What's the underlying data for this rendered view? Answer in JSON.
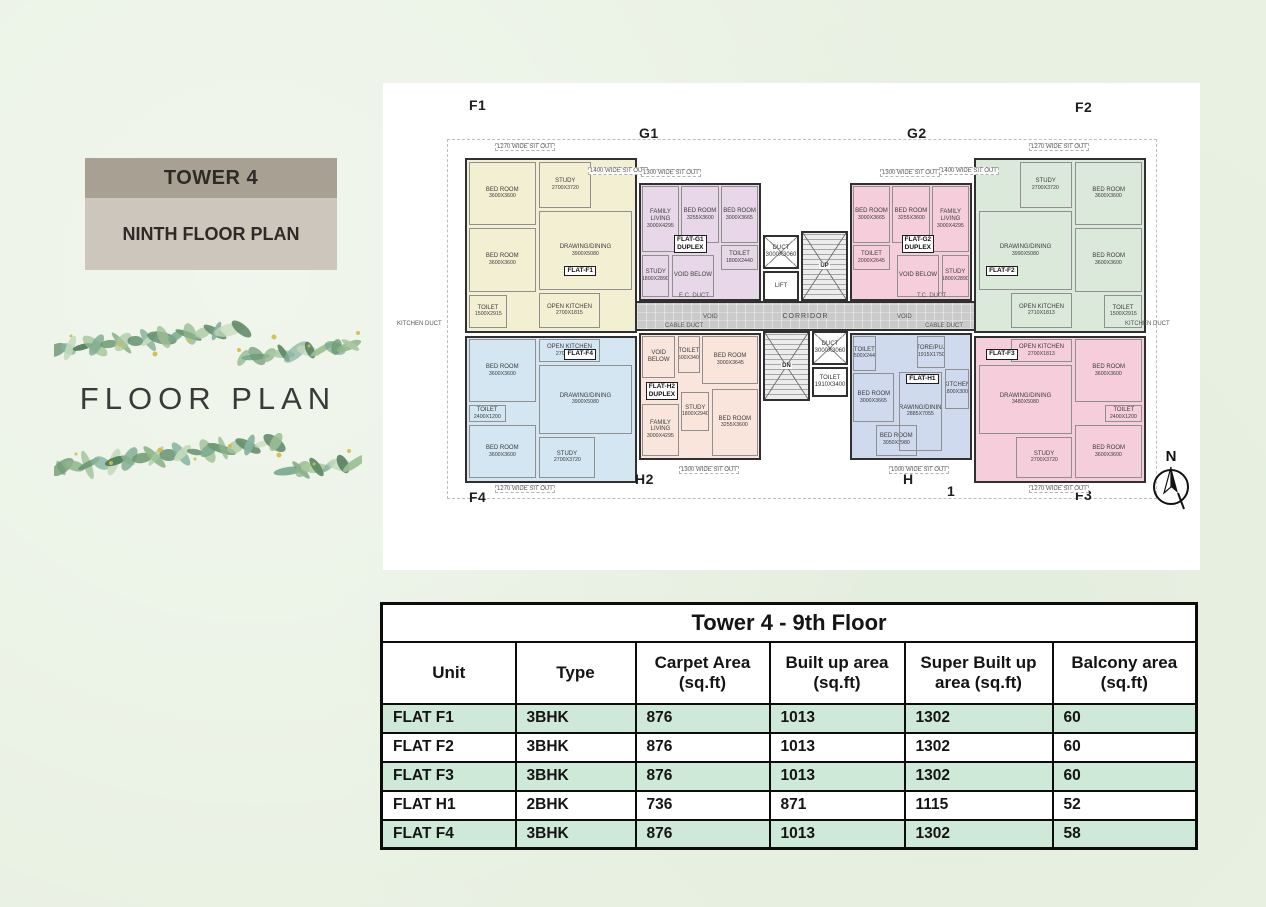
{
  "colors": {
    "page_bg": "#e9f1e3",
    "panel_bg": "#ffffff",
    "badge_top_bg": "#a8a092",
    "badge_bottom_bg": "#cdc6bc",
    "table_green": "#cfe9d8",
    "table_border": "#0c0c0c",
    "wall": "#303030",
    "corridor": "#cacaca",
    "units": {
      "F1": "#f3efd3",
      "G1": "#e8d7e8",
      "G2": "#f6cedb",
      "F2": "#dbe9da",
      "F4": "#d3e6f2",
      "H2": "#f9e5dc",
      "H1": "#cfdaee",
      "F3": "#f6cedb"
    }
  },
  "left_panel": {
    "tower_label": "TOWER 4",
    "floor_label": "NINTH FLOOR PLAN",
    "decor_title": "FLOOR PLAN"
  },
  "floorplan": {
    "north_label": "N",
    "outline": {
      "x": 64,
      "y": 56,
      "w": 710,
      "h": 360
    },
    "corridor": {
      "label": "CORRIDOR",
      "x": 254,
      "y": 218,
      "w": 337,
      "h": 30
    },
    "units": [
      {
        "id": "F1",
        "x": 82,
        "y": 75,
        "w": 172,
        "h": 175,
        "tag": "FLAT-F1",
        "tx": 58,
        "ty": 62,
        "rooms": [
          {
            "n": "BED ROOM",
            "d": "3600X3600",
            "x": 1,
            "y": 1,
            "w": 40,
            "h": 37
          },
          {
            "n": "STUDY",
            "d": "2700X3720",
            "x": 43,
            "y": 1,
            "w": 31,
            "h": 27
          },
          {
            "n": "BED ROOM",
            "d": "3600X3600",
            "x": 1,
            "y": 40,
            "w": 40,
            "h": 37
          },
          {
            "n": "TOILET",
            "d": "1500X2915",
            "x": 1,
            "y": 79,
            "w": 23,
            "h": 19
          },
          {
            "n": "DRAWING/DINING",
            "d": "3900X5080",
            "x": 43,
            "y": 30,
            "w": 55,
            "h": 46
          },
          {
            "n": "OPEN KITCHEN",
            "d": "2700X1815",
            "x": 43,
            "y": 78,
            "w": 36,
            "h": 20
          }
        ]
      },
      {
        "id": "G1",
        "x": 256,
        "y": 100,
        "w": 122,
        "h": 118,
        "tag": "FLAT-G1\nDUPLEX",
        "tx": 28,
        "ty": 44,
        "rooms": [
          {
            "n": "FAMILY LIVING",
            "d": "3000X4295",
            "x": 1,
            "y": 1,
            "w": 31,
            "h": 58
          },
          {
            "n": "BED ROOM",
            "d": "3255X3600",
            "x": 34,
            "y": 1,
            "w": 32,
            "h": 50
          },
          {
            "n": "BED ROOM",
            "d": "3000X3665",
            "x": 68,
            "y": 1,
            "w": 31,
            "h": 50
          },
          {
            "n": "STUDY",
            "d": "1800X2890",
            "x": 1,
            "y": 61,
            "w": 23,
            "h": 37
          },
          {
            "n": "VOID BELOW",
            "d": "",
            "x": 26,
            "y": 61,
            "w": 36,
            "h": 37
          },
          {
            "n": "TOILET",
            "d": "1800X2440",
            "x": 68,
            "y": 53,
            "w": 31,
            "h": 22
          }
        ]
      },
      {
        "id": "G2",
        "x": 467,
        "y": 100,
        "w": 122,
        "h": 118,
        "tag": "FLAT-G2\nDUPLEX",
        "tx": 42,
        "ty": 44,
        "rooms": [
          {
            "n": "BED ROOM",
            "d": "3000X3665",
            "x": 1,
            "y": 1,
            "w": 31,
            "h": 50
          },
          {
            "n": "BED ROOM",
            "d": "3255X3600",
            "x": 34,
            "y": 1,
            "w": 32,
            "h": 50
          },
          {
            "n": "FAMILY LIVING",
            "d": "3000X4295",
            "x": 68,
            "y": 1,
            "w": 31,
            "h": 58
          },
          {
            "n": "TOILET",
            "d": "2000X2645",
            "x": 1,
            "y": 53,
            "w": 31,
            "h": 22
          },
          {
            "n": "VOID BELOW",
            "d": "",
            "x": 38,
            "y": 61,
            "w": 36,
            "h": 37
          },
          {
            "n": "STUDY",
            "d": "1800X2890",
            "x": 76,
            "y": 61,
            "w": 23,
            "h": 37
          }
        ]
      },
      {
        "id": "F2",
        "x": 591,
        "y": 75,
        "w": 172,
        "h": 175,
        "tag": "FLAT-F2",
        "tx": 6,
        "ty": 62,
        "rooms": [
          {
            "n": "STUDY",
            "d": "2700X3720",
            "x": 26,
            "y": 1,
            "w": 31,
            "h": 27
          },
          {
            "n": "BED ROOM",
            "d": "3600X3600",
            "x": 59,
            "y": 1,
            "w": 40,
            "h": 37
          },
          {
            "n": "BED ROOM",
            "d": "3600X3600",
            "x": 59,
            "y": 40,
            "w": 40,
            "h": 37
          },
          {
            "n": "TOILET",
            "d": "1500X2915",
            "x": 76,
            "y": 79,
            "w": 23,
            "h": 19
          },
          {
            "n": "DRAWING/DINING",
            "d": "3990X5080",
            "x": 2,
            "y": 30,
            "w": 55,
            "h": 46
          },
          {
            "n": "OPEN KITCHEN",
            "d": "2710X1813",
            "x": 21,
            "y": 78,
            "w": 36,
            "h": 20
          }
        ]
      },
      {
        "id": "F4",
        "x": 82,
        "y": 253,
        "w": 172,
        "h": 147,
        "tag": "FLAT-F4",
        "tx": 58,
        "ty": 8,
        "rooms": [
          {
            "n": "OPEN KITCHEN",
            "d": "2700X1815",
            "x": 43,
            "y": 1,
            "w": 36,
            "h": 16
          },
          {
            "n": "BED ROOM",
            "d": "3600X3600",
            "x": 1,
            "y": 1,
            "w": 40,
            "h": 44
          },
          {
            "n": "TOILET",
            "d": "2400X1200",
            "x": 1,
            "y": 47,
            "w": 22,
            "h": 12
          },
          {
            "n": "BED ROOM",
            "d": "3600X3600",
            "x": 1,
            "y": 61,
            "w": 40,
            "h": 37
          },
          {
            "n": "DRAWING/DINING",
            "d": "3900X5080",
            "x": 43,
            "y": 19,
            "w": 55,
            "h": 48
          },
          {
            "n": "STUDY",
            "d": "2700X3720",
            "x": 43,
            "y": 69,
            "w": 33,
            "h": 29
          }
        ]
      },
      {
        "id": "H2",
        "x": 256,
        "y": 250,
        "w": 122,
        "h": 127,
        "tag": "FLAT-H2\nDUPLEX",
        "tx": 4,
        "ty": 38,
        "rooms": [
          {
            "n": "VOID BELOW",
            "d": "",
            "x": 1,
            "y": 1,
            "w": 28,
            "h": 34
          },
          {
            "n": "TOILET",
            "d": "1500X3400",
            "x": 31,
            "y": 1,
            "w": 19,
            "h": 30
          },
          {
            "n": "BED ROOM",
            "d": "3000X3645",
            "x": 52,
            "y": 1,
            "w": 47,
            "h": 39
          },
          {
            "n": "FAMILY LIVING",
            "d": "3000X4295",
            "x": 1,
            "y": 56,
            "w": 31,
            "h": 42
          },
          {
            "n": "STUDY",
            "d": "1800X2940",
            "x": 34,
            "y": 46,
            "w": 24,
            "h": 32
          },
          {
            "n": "BED ROOM",
            "d": "3255X3600",
            "x": 60,
            "y": 44,
            "w": 39,
            "h": 54
          }
        ]
      },
      {
        "id": "H1",
        "x": 467,
        "y": 250,
        "w": 122,
        "h": 127,
        "tag": "FLAT-H1",
        "tx": 46,
        "ty": 32,
        "rooms": [
          {
            "n": "TOILET",
            "d": "1500X2440",
            "x": 1,
            "y": 1,
            "w": 19,
            "h": 28
          },
          {
            "n": "STORE/PUJA",
            "d": "1915X1750",
            "x": 55,
            "y": 1,
            "w": 24,
            "h": 26
          },
          {
            "n": "BED ROOM",
            "d": "3000X3665",
            "x": 1,
            "y": 31,
            "w": 35,
            "h": 40
          },
          {
            "n": "BED ROOM",
            "d": "3050X2980",
            "x": 20,
            "y": 73,
            "w": 35,
            "h": 25
          },
          {
            "n": "DRAWING/DINING",
            "d": "2885X7055",
            "x": 40,
            "y": 30,
            "w": 36,
            "h": 64
          },
          {
            "n": "KITCHEN",
            "d": "1800X3000",
            "x": 79,
            "y": 28,
            "w": 20,
            "h": 32
          }
        ]
      },
      {
        "id": "F3",
        "x": 591,
        "y": 253,
        "w": 172,
        "h": 147,
        "tag": "FLAT-F3",
        "tx": 6,
        "ty": 8,
        "rooms": [
          {
            "n": "OPEN KITCHEN",
            "d": "2700X1813",
            "x": 21,
            "y": 1,
            "w": 36,
            "h": 16
          },
          {
            "n": "BED ROOM",
            "d": "3600X3600",
            "x": 59,
            "y": 1,
            "w": 40,
            "h": 44
          },
          {
            "n": "TOILET",
            "d": "2400X1200",
            "x": 77,
            "y": 47,
            "w": 22,
            "h": 12
          },
          {
            "n": "BED ROOM",
            "d": "3600X3600",
            "x": 59,
            "y": 61,
            "w": 40,
            "h": 37
          },
          {
            "n": "DRAWING/DINING",
            "d": "3480X5080",
            "x": 2,
            "y": 19,
            "w": 55,
            "h": 48
          },
          {
            "n": "STUDY",
            "d": "2700X3720",
            "x": 24,
            "y": 69,
            "w": 33,
            "h": 29
          }
        ]
      }
    ],
    "core": [
      {
        "type": "duct",
        "n": "DUCT",
        "d": "3000X3060",
        "x": 380,
        "y": 152,
        "w": 36,
        "h": 34
      },
      {
        "type": "lift",
        "n": "LIFT",
        "d": "",
        "x": 380,
        "y": 188,
        "w": 36,
        "h": 30
      },
      {
        "type": "stair",
        "n": "UP",
        "d": "",
        "x": 418,
        "y": 148,
        "w": 47,
        "h": 70
      },
      {
        "type": "stair",
        "n": "DN",
        "d": "",
        "x": 380,
        "y": 248,
        "w": 47,
        "h": 70
      },
      {
        "type": "duct",
        "n": "DUCT",
        "d": "3000X3060",
        "x": 429,
        "y": 248,
        "w": 36,
        "h": 34
      },
      {
        "type": "toilet",
        "n": "TOILET",
        "d": "1910X3400",
        "x": 429,
        "y": 284,
        "w": 36,
        "h": 30
      }
    ],
    "labels": [
      {
        "kind": "corner",
        "text": "F1",
        "x": 86,
        "y": 14
      },
      {
        "kind": "corner",
        "text": "G1",
        "x": 256,
        "y": 42
      },
      {
        "kind": "corner",
        "text": "G2",
        "x": 524,
        "y": 42
      },
      {
        "kind": "corner",
        "text": "F2",
        "x": 692,
        "y": 16
      },
      {
        "kind": "corner",
        "text": "F4",
        "x": 86,
        "y": 406
      },
      {
        "kind": "corner",
        "text": "H2",
        "x": 252,
        "y": 388
      },
      {
        "kind": "corner",
        "text": "H",
        "x": 520,
        "y": 388
      },
      {
        "kind": "corner",
        "text": "1",
        "x": 564,
        "y": 400
      },
      {
        "kind": "corner",
        "text": "F3",
        "x": 692,
        "y": 404
      },
      {
        "kind": "sitout",
        "text": "1270 WIDE SIT OUT",
        "x": 112,
        "y": 60
      },
      {
        "kind": "sitout",
        "text": "1400 WIDE SIT OUT",
        "x": 205,
        "y": 84
      },
      {
        "kind": "sitout",
        "text": "1300 WIDE SIT OUT",
        "x": 258,
        "y": 86
      },
      {
        "kind": "sitout",
        "text": "1300 WIDE SIT OUT",
        "x": 497,
        "y": 86
      },
      {
        "kind": "sitout",
        "text": "1400 WIDE SIT OUT",
        "x": 556,
        "y": 84
      },
      {
        "kind": "sitout",
        "text": "1270 WIDE SIT OUT",
        "x": 646,
        "y": 60
      },
      {
        "kind": "sitout",
        "text": "1270 WIDE SIT OUT",
        "x": 112,
        "y": 402
      },
      {
        "kind": "sitout",
        "text": "1300 WIDE SIT OUT",
        "x": 296,
        "y": 383
      },
      {
        "kind": "sitout",
        "text": "1000 WIDE SIT OUT",
        "x": 506,
        "y": 383
      },
      {
        "kind": "sitout",
        "text": "1270 WIDE SIT OUT",
        "x": 646,
        "y": 402
      },
      {
        "kind": "tiny",
        "text": "KITCHEN DUCT",
        "x": 14,
        "y": 238
      },
      {
        "kind": "tiny",
        "text": "KITCHEN DUCT",
        "x": 742,
        "y": 238
      },
      {
        "kind": "tiny",
        "text": "CABLE DUCT",
        "x": 282,
        "y": 240
      },
      {
        "kind": "tiny",
        "text": "VOID",
        "x": 320,
        "y": 231
      },
      {
        "kind": "tiny",
        "text": "VOID",
        "x": 514,
        "y": 231
      },
      {
        "kind": "tiny",
        "text": "CABLE DUCT",
        "x": 542,
        "y": 240
      },
      {
        "kind": "tiny",
        "text": "E.C. DUCT",
        "x": 296,
        "y": 210
      },
      {
        "kind": "tiny",
        "text": "T.C. DUCT",
        "x": 534,
        "y": 210
      }
    ]
  },
  "table": {
    "title": "Tower 4 - 9th Floor",
    "columns": [
      "Unit",
      "Type",
      "Carpet Area\n(sq.ft)",
      "Built up area\n(sq.ft)",
      "Super Built up\narea (sq.ft)",
      "Balcony area\n(sq.ft)"
    ],
    "col_widths": [
      134,
      120,
      134,
      135,
      148,
      144
    ],
    "rows": [
      {
        "cells": [
          "FLAT F1",
          "3BHK",
          "876",
          "1013",
          "1302",
          "60"
        ]
      },
      {
        "cells": [
          "FLAT F2",
          "3BHK",
          "876",
          "1013",
          "1302",
          "60"
        ]
      },
      {
        "cells": [
          "FLAT F3",
          "3BHK",
          "876",
          "1013",
          "1302",
          "60"
        ]
      },
      {
        "cells": [
          "FLAT H1",
          "2BHK",
          "736",
          "871",
          "1115",
          "52"
        ]
      },
      {
        "cells": [
          "FLAT F4",
          "3BHK",
          "876",
          "1013",
          "1302",
          "58"
        ]
      }
    ]
  }
}
